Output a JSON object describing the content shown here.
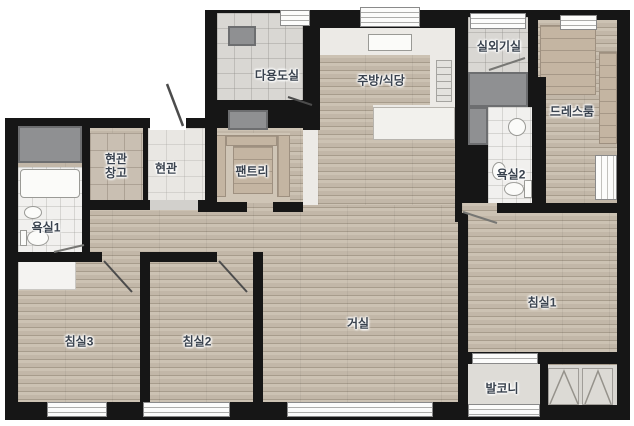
{
  "plan": {
    "type": "apartment-floor-plan",
    "rooms": [
      {
        "id": "utility-room",
        "label": "다용도실"
      },
      {
        "id": "kitchen-dining",
        "label": "주방/식당"
      },
      {
        "id": "outdoor-unit-room",
        "label": "실외기실"
      },
      {
        "id": "dress-room",
        "label": "드레스룸"
      },
      {
        "id": "entrance-storage",
        "label": "현관 창고"
      },
      {
        "id": "entrance",
        "label": "현관"
      },
      {
        "id": "pantry",
        "label": "팬트리"
      },
      {
        "id": "bathroom-2",
        "label": "욕실2"
      },
      {
        "id": "bathroom-1",
        "label": "욕실1"
      },
      {
        "id": "bedroom-3",
        "label": "침실3"
      },
      {
        "id": "bedroom-2",
        "label": "침실2"
      },
      {
        "id": "living-room",
        "label": "거실"
      },
      {
        "id": "bedroom-1",
        "label": "침실1"
      },
      {
        "id": "balcony",
        "label": "발코니"
      }
    ],
    "colors": {
      "wall": "#161616",
      "wood_floor": "#c6bbac",
      "kitchen_floor": "#eceae6",
      "tile_floor": "#d9d7d3",
      "bath_tile": "#f1f0ee",
      "gray_unit": "#8f9092",
      "label_text": "#39424e",
      "background": "#ffffff"
    }
  }
}
